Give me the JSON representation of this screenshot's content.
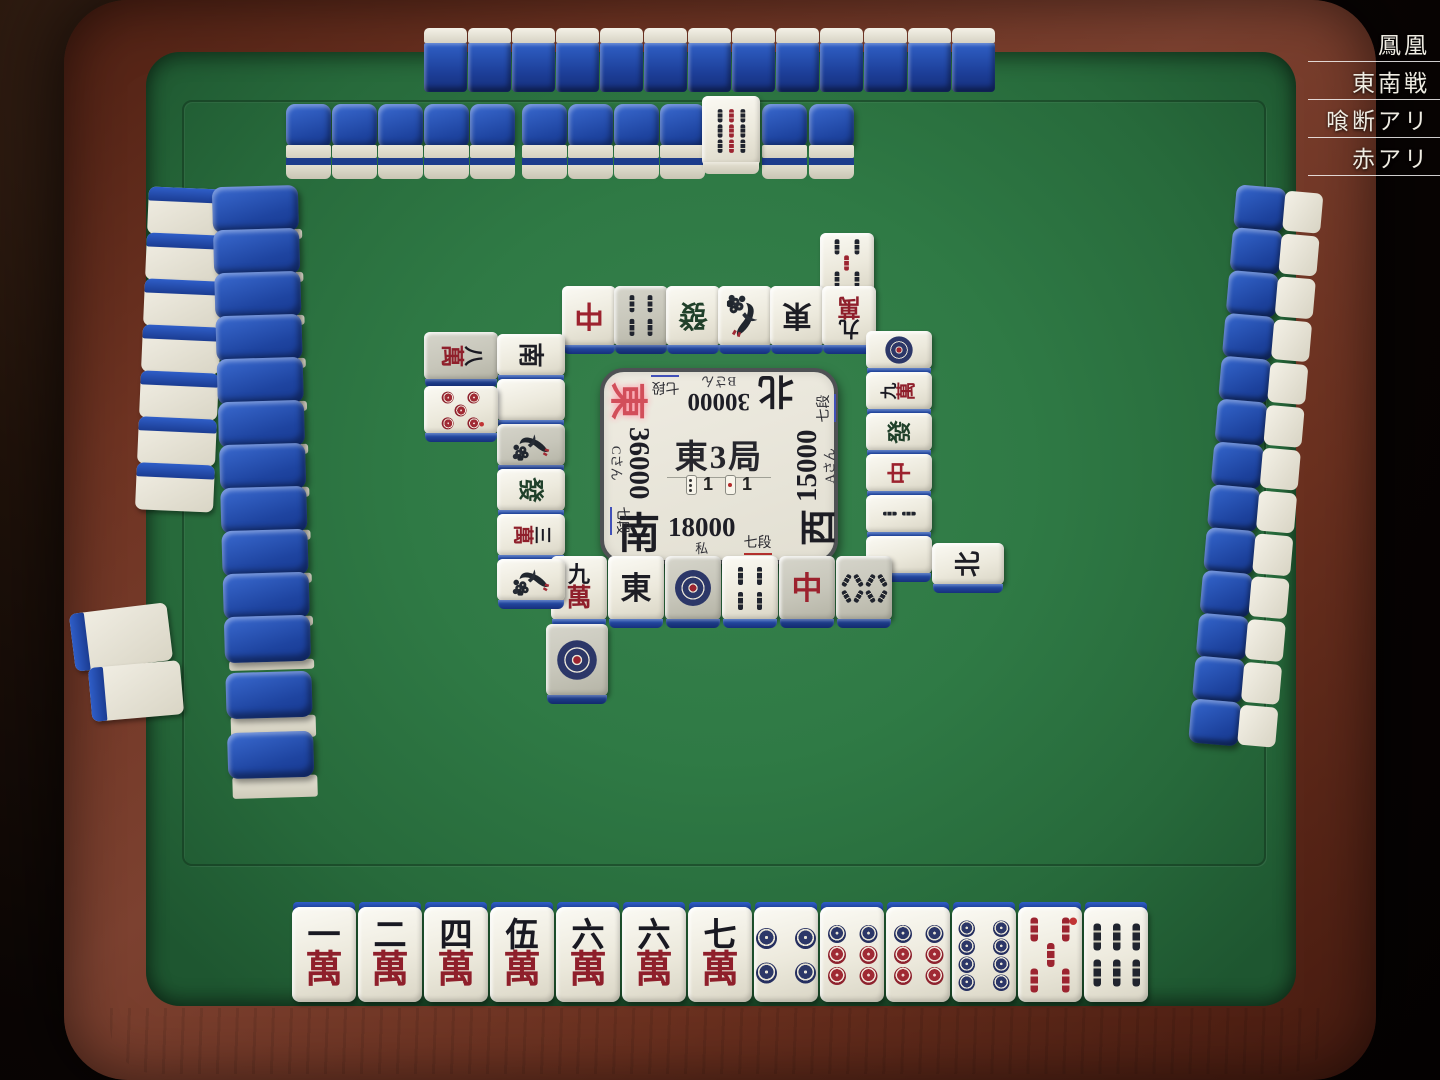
{
  "ruleset": {
    "labels": [
      "鳳凰",
      "東南戦",
      "喰断アリ",
      "赤アリ"
    ]
  },
  "center": {
    "round": "東3局",
    "honba_count": "1",
    "riichi_count": "1",
    "players": {
      "bottom": {
        "wind": "南",
        "score": "18000",
        "rank": "七段",
        "name": "私",
        "rank_underline": "#b3302e"
      },
      "left": {
        "wind": "東",
        "score": "36000",
        "rank": "七段",
        "name": "Cさん",
        "rank_underline": "#4150b8",
        "dealer": true
      },
      "top": {
        "wind": "北",
        "score": "30000",
        "rank": "七段",
        "name": "Bさん",
        "rank_underline": "#4150b8"
      },
      "right": {
        "wind": "西",
        "score": "15000",
        "rank": "七段",
        "name": "Aさん",
        "rank_underline": "#4150b8"
      }
    }
  },
  "hand": [
    "1m",
    "2m",
    "4m",
    "5m",
    "6m",
    "6m",
    "7m",
    "4p",
    "6p",
    "6p",
    "8p",
    "5sr",
    "6s"
  ],
  "discards": {
    "bottom": {
      "rows": [
        [
          "9m",
          "E",
          "1p*",
          "4s",
          "C*",
          "8s*"
        ],
        [
          "1p*"
        ]
      ]
    },
    "top": {
      "rows": [
        [
          "C",
          "4s*",
          "F",
          "1s",
          "E",
          "9m"
        ],
        [
          "5s"
        ]
      ]
    },
    "left": {
      "rows": [
        [
          "S",
          "H",
          "1s*",
          "F",
          "3m",
          "1s"
        ],
        [
          "8m*",
          "5pr"
        ]
      ]
    },
    "right": {
      "rows": [
        [
          "1p",
          "9m",
          "F",
          "C",
          "2s",
          "H"
        ],
        [
          "N"
        ]
      ]
    }
  },
  "dora_indicator": "9s",
  "walls": {
    "top_count": 13,
    "dead_segment_a": 5,
    "dead_segment_b": 4,
    "dead_segment_c": 2,
    "left_outer_count": 7,
    "left_main_count": 13,
    "right_count": 13,
    "corner_white_stacks": 2
  },
  "tile_glyphs": {
    "man_numbers": [
      "一",
      "二",
      "三",
      "四",
      "伍",
      "六",
      "七",
      "八",
      "九"
    ],
    "man_suit": "萬",
    "honors": {
      "E": "東",
      "S": "南",
      "W": "西",
      "N": "北",
      "C": "中",
      "F": "發",
      "H": ""
    }
  },
  "colors": {
    "tile_back_blue": "#1d40a0",
    "felt_green": "#2e7a45",
    "red_accent": "#9c2430",
    "pin_blue": "#2c3768",
    "rank_self_underline": "#b3302e",
    "rank_other_underline": "#4150b8"
  }
}
